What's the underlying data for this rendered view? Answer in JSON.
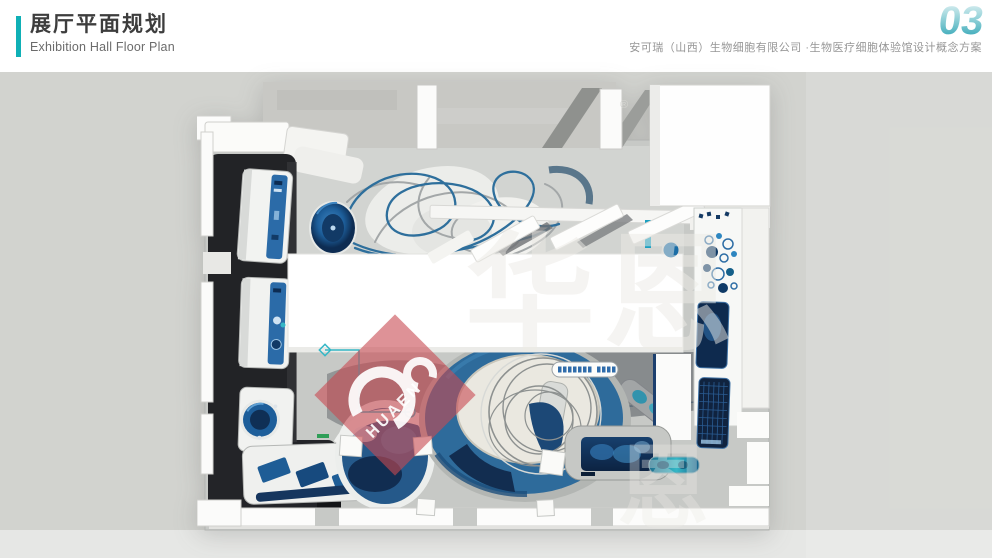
{
  "header": {
    "title": "展厅平面规划",
    "subtitle": "Exhibition Hall Floor Plan",
    "page_number": "03",
    "company_line": "安可瑞（山西）生物细胞有限公司 ·生物医疗细胞体验馆设计概念方案"
  },
  "watermark": {
    "brand_text": "HUAEN",
    "faint_text_large": "华恩",
    "faint_text_small": "恩",
    "registered_symbol": "®",
    "diamond_color": "#c84a52"
  },
  "colors": {
    "header_accent_teal": "#0fb0b6",
    "page_number_teal": "#2ba3b4",
    "slide_background": "#d2d3cf",
    "plan_floor_gray": "#c7c9c6",
    "plan_wall_white": "#fcfcfb",
    "plan_black_wall": "#222326",
    "plan_exhibit_blue": "#2e6b9b",
    "plan_screen_navy": "#0e2a4e",
    "plan_accent_teal": "#35b7c6",
    "plan_platform_cream": "#eae8e0",
    "watermark_red": "#c84a52"
  }
}
